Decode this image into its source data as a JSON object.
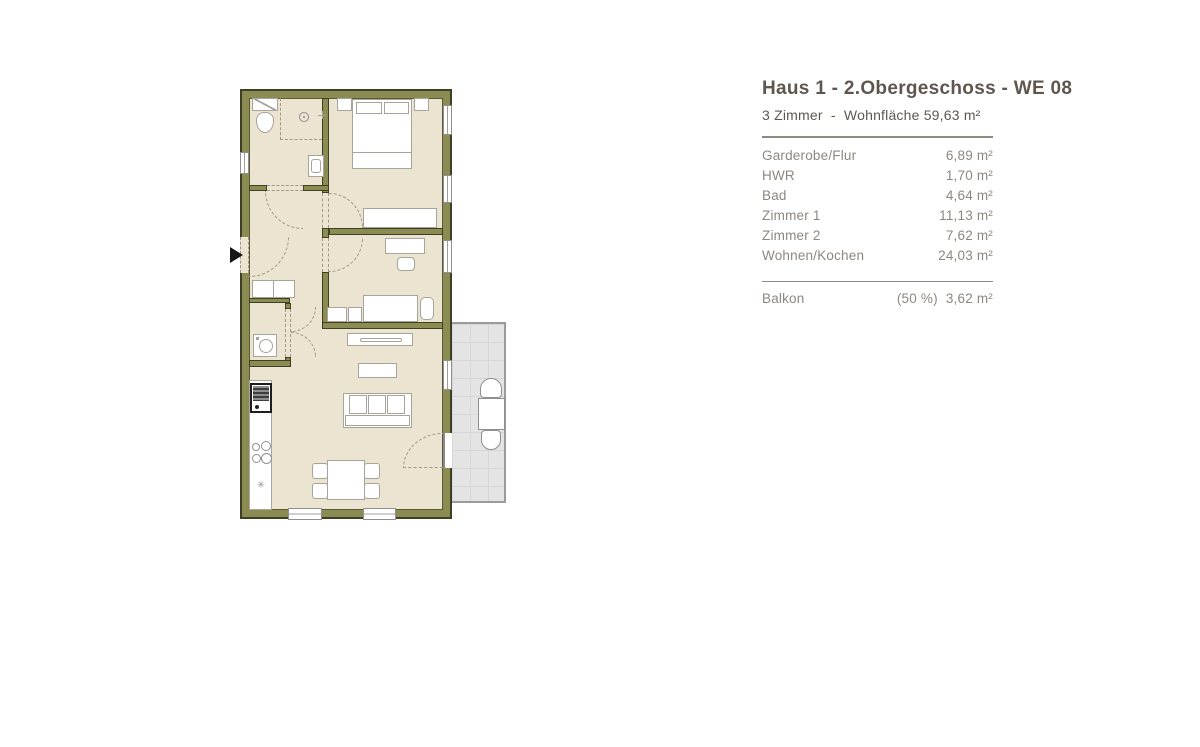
{
  "header": {
    "title": "Haus 1 - 2.Obergeschoss - WE 08",
    "subtitle": "3 Zimmer  -  Wohnfläche 59,63 m²"
  },
  "area_table": {
    "rows": [
      {
        "label": "Garderobe/Flur",
        "value": "6,89 m²"
      },
      {
        "label": "HWR",
        "value": "1,70 m²"
      },
      {
        "label": "Bad",
        "value": "4,64 m²"
      },
      {
        "label": "Zimmer 1",
        "value": "11,13 m²"
      },
      {
        "label": "Zimmer 2",
        "value": "7,62 m²"
      },
      {
        "label": "Wohnen/Kochen",
        "value": "24,03 m²"
      }
    ],
    "balcony": {
      "label": "Balkon",
      "note": "(50 %)",
      "value": "3,62 m²"
    }
  },
  "floorplan": {
    "symbols": {
      "drain_star": "✳"
    },
    "colors": {
      "wall": "#8b8c52",
      "wall_edge": "#3f3f26",
      "floor": "#ebe4d1",
      "balcony": "#e4e4e4",
      "title_text": "#5f574e",
      "table_text": "#8d8780"
    }
  }
}
